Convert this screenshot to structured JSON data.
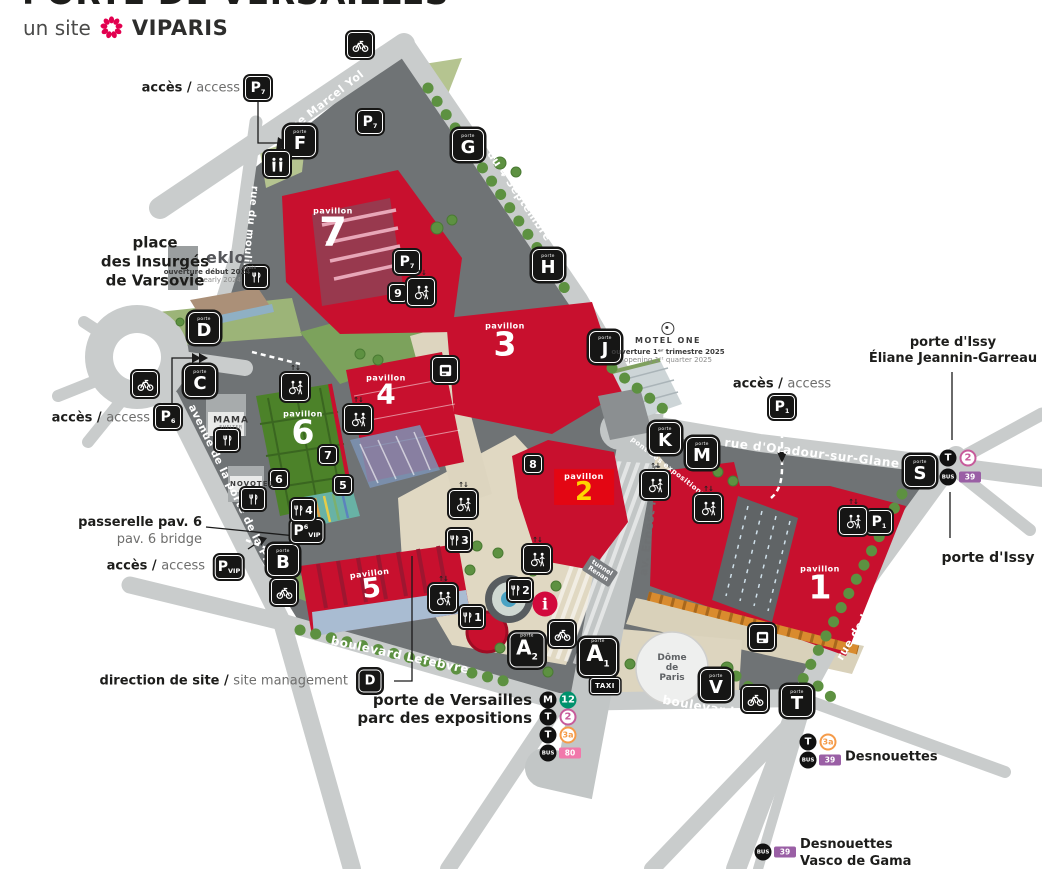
{
  "header": {
    "title": "PORTE DE VERSAILLES",
    "site_prefix": "un site",
    "brand": "VIPARIS"
  },
  "access": {
    "bold": "accès /",
    "regular": "access"
  },
  "labels": {
    "place": [
      "place",
      "des Insurgés",
      "de Varsovie"
    ],
    "passerelle_bold": "passerelle pav. 6",
    "passerelle_reg": "pav. 6 bridge",
    "direction_bold": "direction de site /",
    "direction_reg": "site management",
    "pdv1": "porte de Versailles",
    "pdv2": "parc des expositions",
    "issy_top1": "porte d'Issy",
    "issy_top2": "Éliane Jeannin-Garreau",
    "issy_bottom": "porte d'Issy",
    "desnouettes": "Desnouettes",
    "vasco1": "Desnouettes",
    "vasco2": "Vasco de Gama",
    "dome": [
      "Dôme",
      "de",
      "Paris"
    ],
    "taxi": "TAXI",
    "info": "i"
  },
  "streets": {
    "marcel_yol": "rue Marcel Yol",
    "septembre": "rue du 4 Septembre",
    "moulin": "rue du moulin",
    "plaine": "avenue de la porte de la Plaine",
    "lefebvre": "boulevard Lefebvre",
    "victor": "boulevard Victor",
    "issy": "rue de la porte d'Issy",
    "oradour": "rue d'Oradour-sur-Glane",
    "renan": "av. Ernest Renan",
    "pont": "pont des expositions",
    "tunnel": "tunnel Renan"
  },
  "gate_prefix": "porte",
  "gates": {
    "f": "F",
    "g": "G",
    "h": "H",
    "d": "D",
    "c": "C",
    "j": "J",
    "k": "K",
    "m": "M",
    "s": "S",
    "b": "B",
    "v": "V",
    "t": "T",
    "a": "A",
    "a1_sub": "1",
    "a2_sub": "2",
    "direction": "D"
  },
  "pavilion_word": "pavillon",
  "pavilions": {
    "p1": "1",
    "p2": "2",
    "p3": "3",
    "p4": "4",
    "p5": "5",
    "p6": "6",
    "p7": "7"
  },
  "annexes": {
    "n5": "5",
    "n6": "6",
    "n7": "7",
    "n8": "8",
    "n9": "9"
  },
  "restaurants": {
    "r1": "1",
    "r2": "2",
    "r3": "3",
    "r4": "4"
  },
  "parkings": {
    "p7": {
      "p": "P",
      "sub": "7"
    },
    "p6": {
      "p": "P",
      "sub": "6"
    },
    "p1": {
      "p": "P",
      "sub": "1"
    },
    "pvip": {
      "p": "P",
      "sub": "VIP"
    },
    "p6vip": {
      "p": "P",
      "sup": "6",
      "sub": "VIP"
    }
  },
  "hotels": {
    "eklo_name": "eklo",
    "eklo_sub": "hotels",
    "eklo_fr": "ouverture début 2024",
    "eklo_en": "opening early 2024",
    "motel_name": "MOTEL ONE",
    "motel_fr": "ouverture 1ᵉʳ trimestre 2025",
    "motel_en": "opening 1ˢᵗ quarter 2025",
    "mama_name": "MAMA",
    "mama_sub": "SHELTER",
    "novotel": "NOVOTEL"
  },
  "transit": {
    "m": "M",
    "t": "T",
    "bus": "BUS",
    "m12": "12",
    "t2": "2",
    "t3a": "3a",
    "b39": "39",
    "b80": "80"
  },
  "colors": {
    "pavilion_red": "#c8102e",
    "pavilion2_red": "#e30613",
    "pavilion2_number_yellow": "#ffd400",
    "green_roof": "#4c8229",
    "metro12": "#00916c",
    "tram2": "#c75b9b",
    "tram3a": "#f59b49",
    "bus39": "#9a5fa5",
    "bus80": "#f178ab",
    "brand_pink": "#e2004f",
    "site_gray": "#6f7375",
    "road_gray": "#c9cccc",
    "esplanade_beige": "#e0d8c2"
  }
}
